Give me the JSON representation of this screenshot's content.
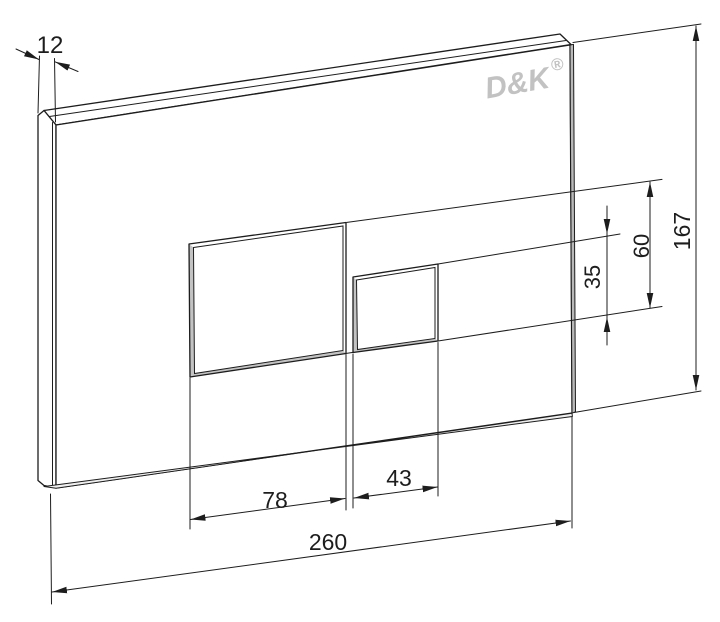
{
  "logo": {
    "text": "D&K",
    "registered": "®"
  },
  "dims": {
    "thickness": "12",
    "height": "167",
    "width": "260",
    "large_button_width": "78",
    "small_button_width": "43",
    "small_button_height": "35",
    "large_button_height": "60"
  },
  "colors": {
    "line": "#1d1d1d",
    "edge": "#b9b9b9",
    "button_edge": "#c3c3c3",
    "bottom_edge": "#efefef",
    "logo": "#c2c2c2",
    "background": "#ffffff"
  }
}
